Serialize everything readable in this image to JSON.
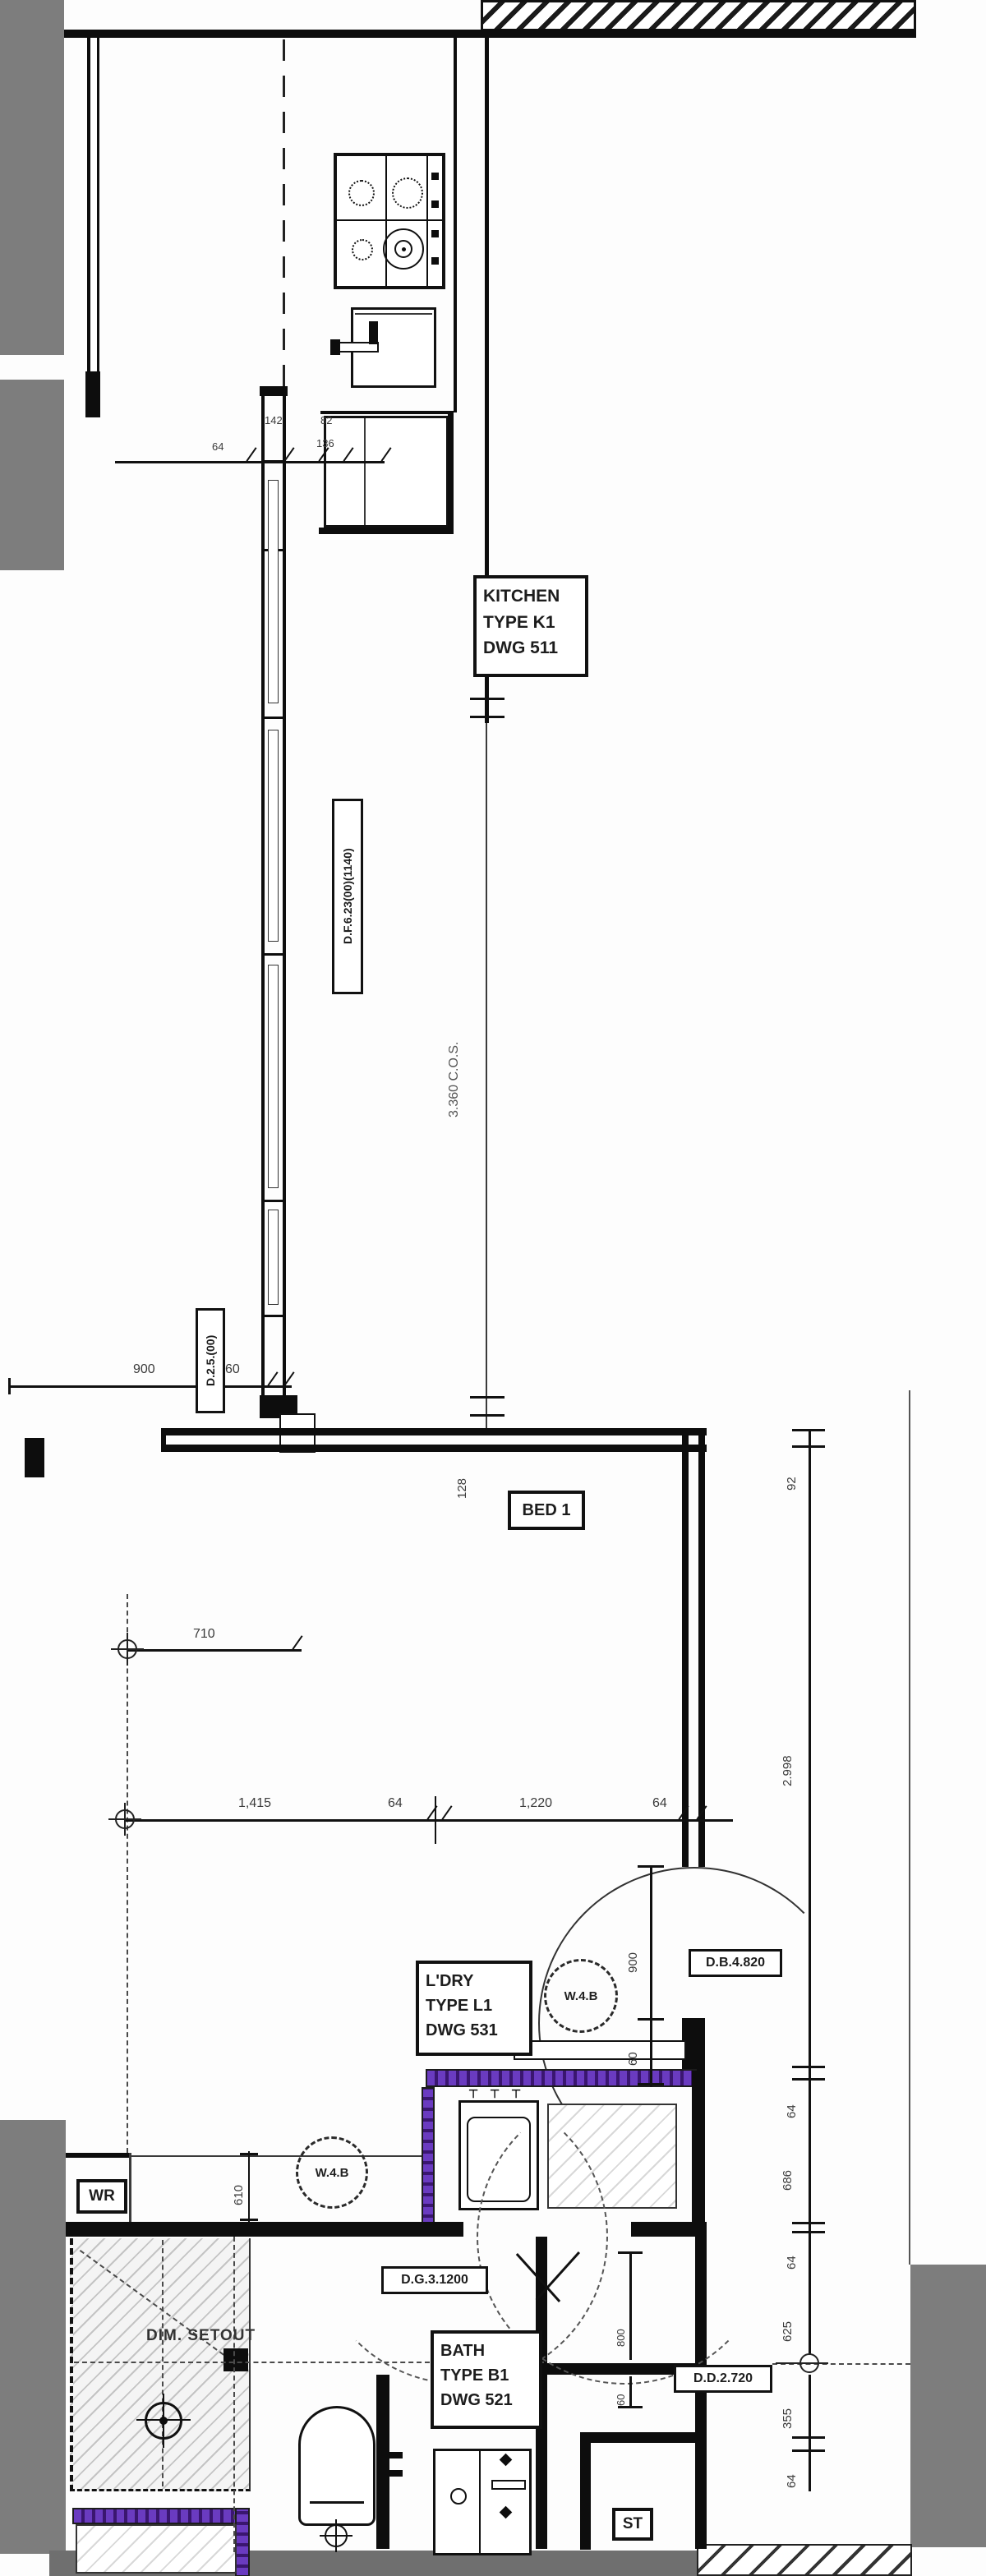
{
  "labels": {
    "kitchen": {
      "l1": "KITCHEN",
      "l2": "TYPE K1",
      "l3": "DWG 511"
    },
    "bed": "BED 1",
    "ldry": {
      "l1": "L'DRY",
      "l2": "TYPE L1",
      "l3": "DWG 531"
    },
    "bath": {
      "l1": "BATH",
      "l2": "TYPE B1",
      "l3": "DWG 521"
    },
    "wr": "WR",
    "st": "ST",
    "dim_setout": "DIM. SETOUT",
    "door_f": "D.F.6.23(00)(1140)",
    "door_25": "D.2.5.(00)",
    "db": "D.B.4.820",
    "dd": "D.D.2.720",
    "dg": "D.G.3.1200",
    "cos": "3.360 C.O.S.",
    "w4b": "W.4.B",
    "tap": "⊤"
  },
  "dims": {
    "top": [
      "64",
      "142",
      "82",
      "136"
    ],
    "left_900": "900",
    "left_60": "60",
    "strip_710": "710",
    "bed_128": "128",
    "bed_w": [
      "1,415",
      "64",
      "1,220",
      "64"
    ],
    "right": [
      "92",
      "2.998",
      "64",
      "686",
      "64",
      "625",
      "355",
      "64"
    ],
    "ldry_900": "900",
    "ldry_60": "60",
    "st_800": "800",
    "st_60": "60",
    "wr_610": "610"
  },
  "colors": {
    "wall": "#0d0d0d",
    "structure_gray": "#7d7d7d",
    "acoustic_purple": "#5b2ca8",
    "dim_text": "#3a3a3a"
  }
}
